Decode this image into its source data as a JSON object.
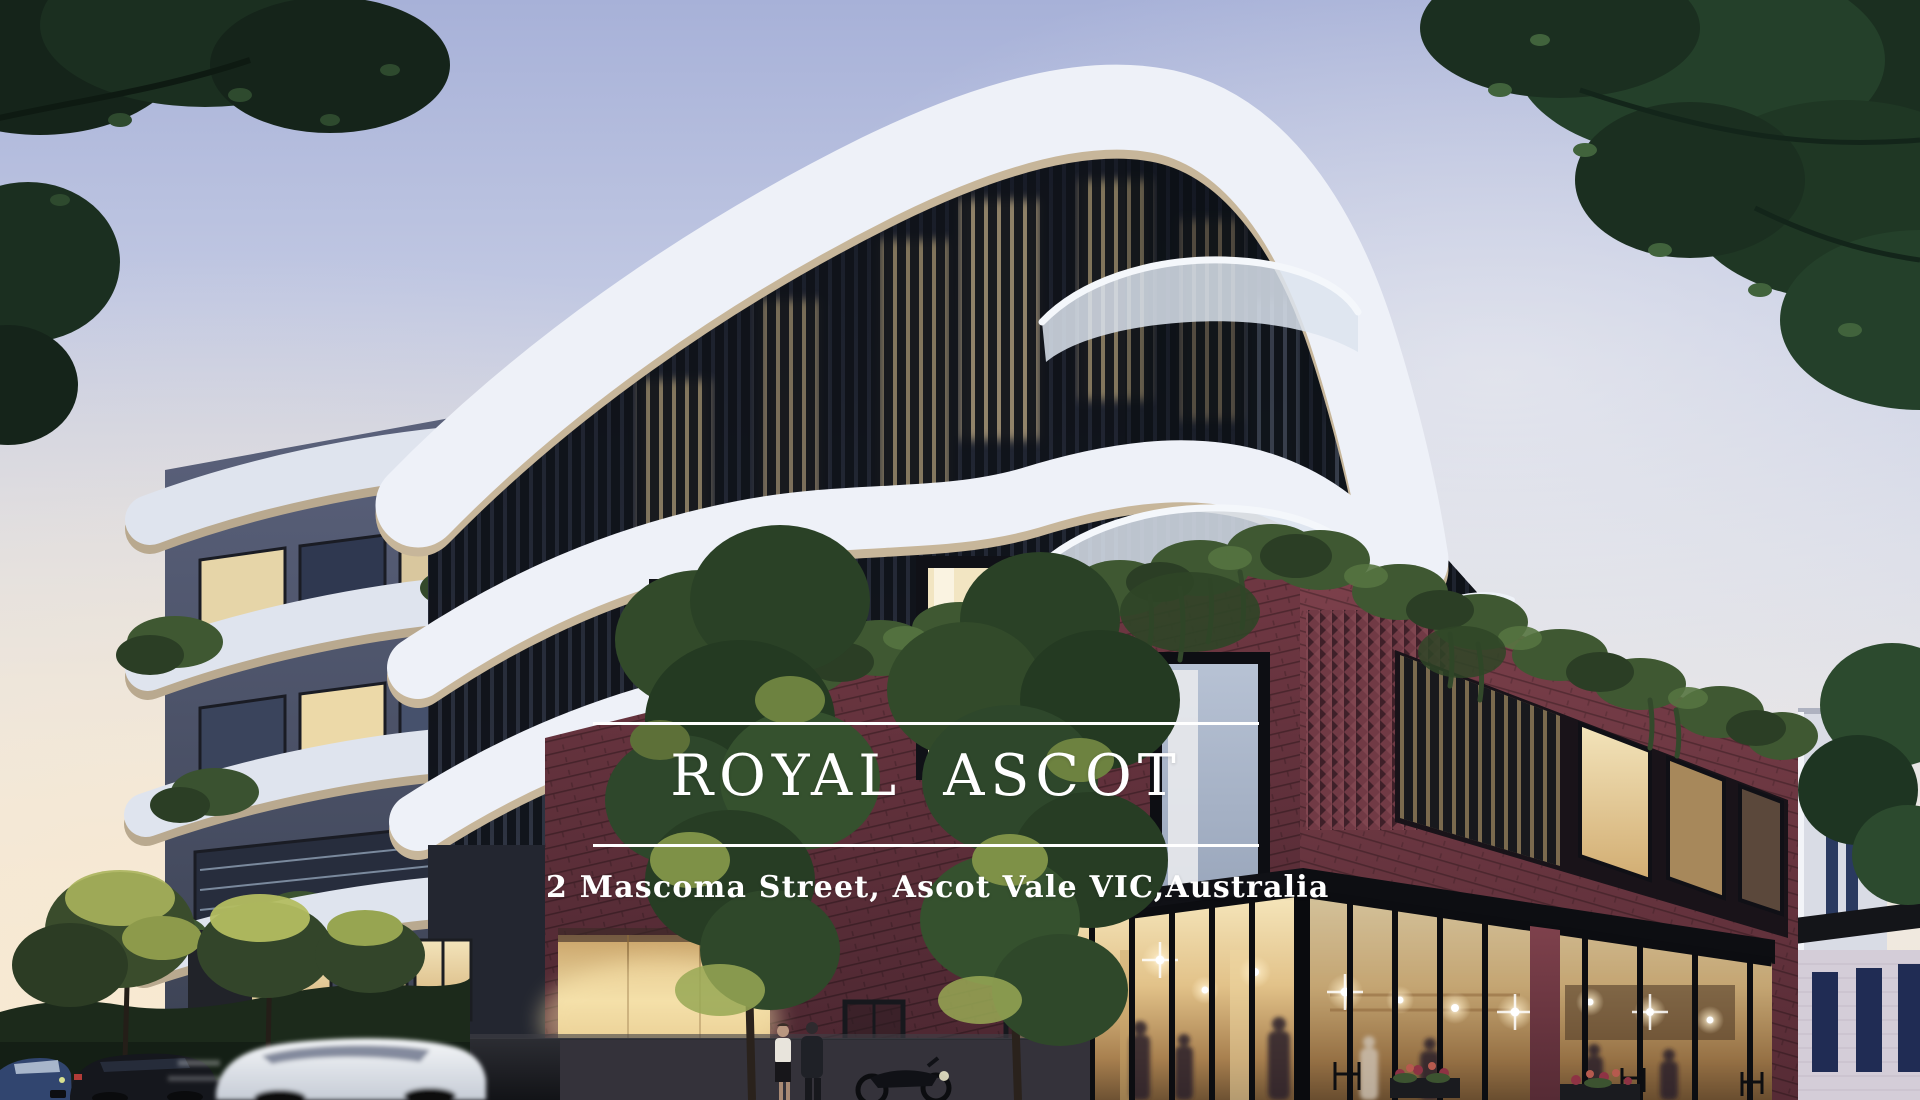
{
  "overlay": {
    "title": "ROYAL ASCOT",
    "address": "2 Mascoma Street, Ascot Vale VIC,Australia",
    "text_color": "#ffffff",
    "rule_color": "#ffffff"
  },
  "scene": {
    "description": "Dusk architectural render of the Royal Ascot apartment building: curved white floor bands over dark slatted glazing, red brick podium with rooftop greenery, glowing corner cafe, street trees and passing cars.",
    "colors": {
      "sky_top": "#a7b1d8",
      "sky_mid": "#d8dbe7",
      "sky_horizon_warm": "#f5ecda",
      "band_white": "#edf1f8",
      "band_soffit": "#c7b69a",
      "glazing_dark": "#141823",
      "window_glow": "#e8c98c",
      "brick_left_face": "#5e2e39",
      "brick_right_face": "#7e414c",
      "parapet_greenery": "#3f5832",
      "gold_entry_wall": "#ecd9a4",
      "cafe_glass_glow": "#e2c289",
      "canopy_dark": "#141519",
      "road_dark": "#17181c",
      "tree_foliage_dark": "#1b2f20",
      "tree_foliage_lit": "#9fae4e",
      "neighbor_building": "#d9dce5",
      "neighbor_window_blue": "#2a3a60"
    }
  }
}
